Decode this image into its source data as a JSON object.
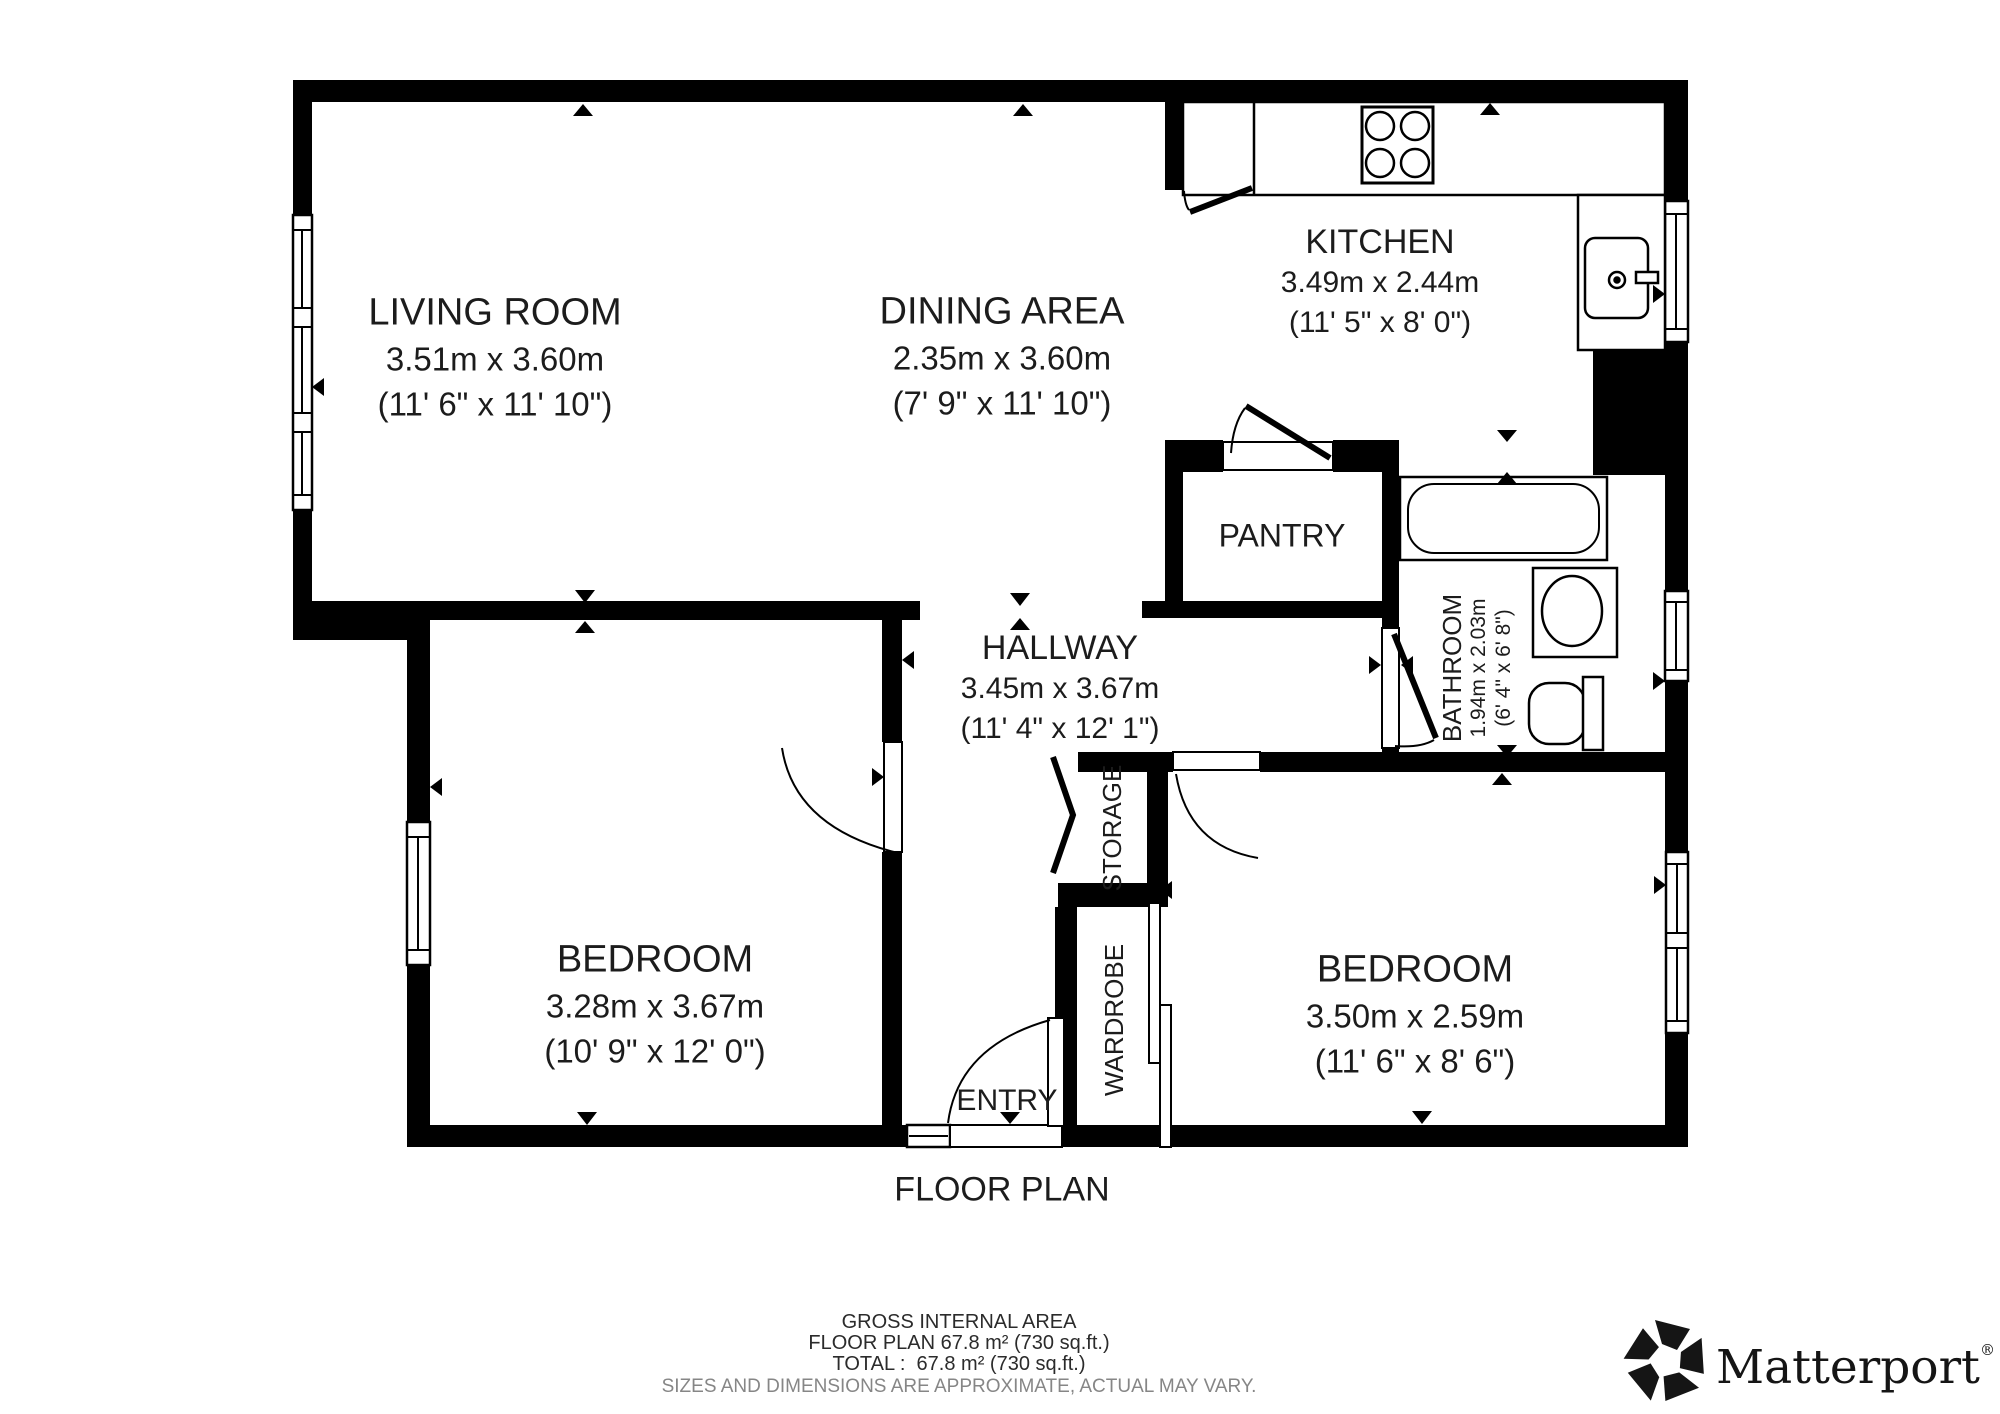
{
  "rooms": {
    "living": {
      "name": "LIVING ROOM",
      "metric": "3.51m x 3.60m",
      "imperial": "(11' 6\" x 11' 10\")"
    },
    "dining": {
      "name": "DINING AREA",
      "metric": "2.35m x 3.60m",
      "imperial": "(7' 9\" x 11' 10\")"
    },
    "kitchen": {
      "name": "KITCHEN",
      "metric": "3.49m x 2.44m",
      "imperial": "(11' 5\" x 8' 0\")"
    },
    "pantry": {
      "name": "PANTRY"
    },
    "hallway": {
      "name": "HALLWAY",
      "metric": "3.45m x 3.67m",
      "imperial": "(11' 4\" x 12' 1\")"
    },
    "bathroom": {
      "name": "BATHROOM",
      "metric": "1.94m x 2.03m",
      "imperial": "(6' 4\" x 6' 8\")"
    },
    "bedroom_left": {
      "name": "BEDROOM",
      "metric": "3.28m x 3.67m",
      "imperial": "(10' 9\" x 12' 0\")"
    },
    "bedroom_right": {
      "name": "BEDROOM",
      "metric": "3.50m x 2.59m",
      "imperial": "(11' 6\" x 8' 6\")"
    },
    "storage": {
      "name": "STORAGE"
    },
    "wardrobe": {
      "name": "WARDROBE"
    },
    "entry": {
      "name": "ENTRY"
    }
  },
  "titles": {
    "floor_plan": "FLOOR PLAN"
  },
  "footer": {
    "line1": "GROSS INTERNAL AREA",
    "line2": "FLOOR PLAN 67.8 m² (730 sq.ft.)",
    "line3": "TOTAL :  67.8 m² (730 sq.ft.)",
    "disclaimer": "SIZES AND DIMENSIONS ARE APPROXIMATE, ACTUAL MAY VARY."
  },
  "brand": {
    "name": "Matterport",
    "registered": "®"
  },
  "icons": [
    "stove-icon",
    "kitchen-sink-icon",
    "bathtub-icon",
    "bathroom-sink-icon",
    "toilet-icon",
    "matterport-pinwheel-icon"
  ],
  "colors": {
    "wall": "#000000",
    "text": "#1c1c1c",
    "muted": "#868686"
  }
}
